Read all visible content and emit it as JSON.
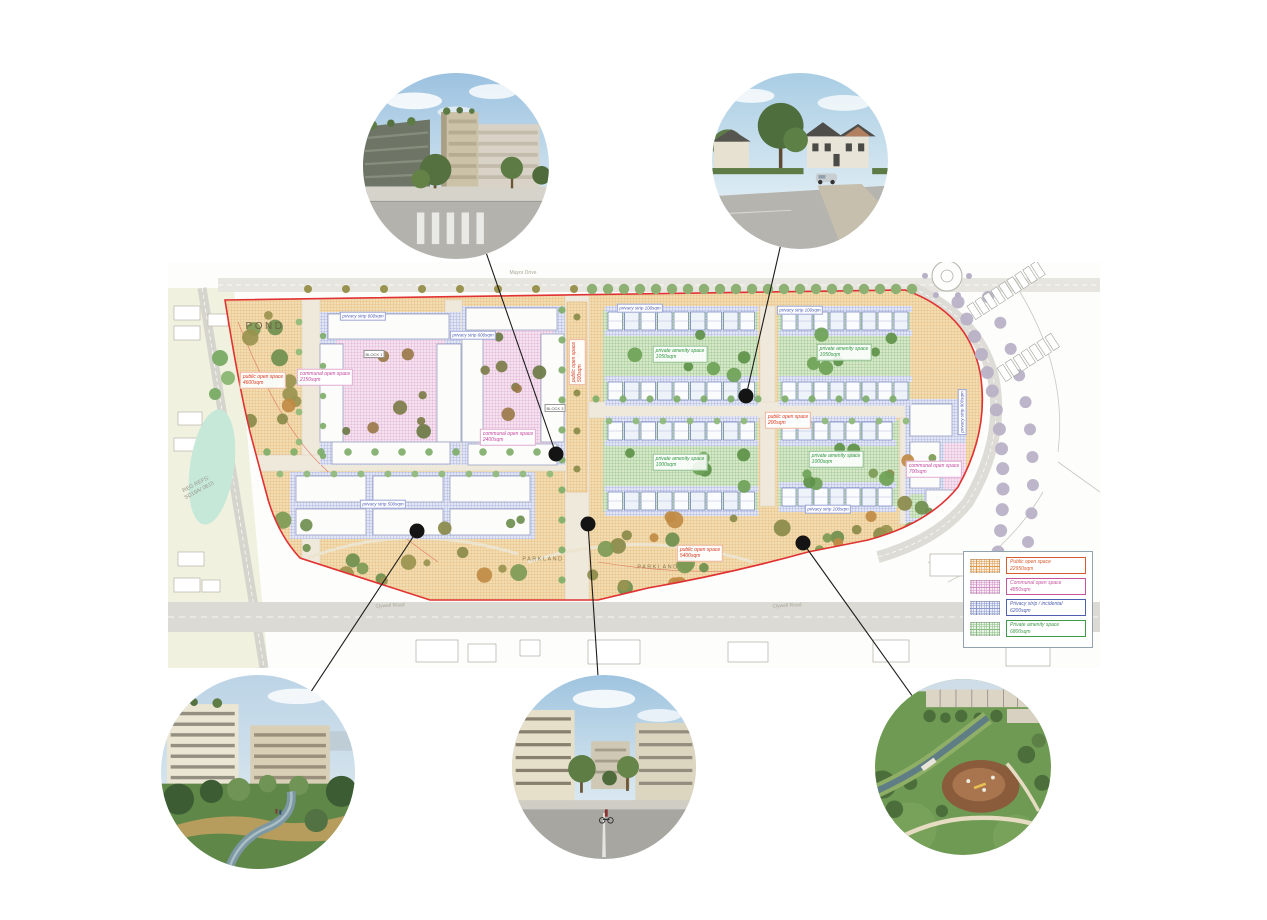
{
  "page": {
    "background": "#ffffff"
  },
  "legend": {
    "items": [
      {
        "label": "Public open space",
        "area": "22950sqm",
        "color": "#d95b2e",
        "fill": "#fbf0e2",
        "line": "#e09a4e"
      },
      {
        "label": "Communal open space",
        "area": "4850sqm",
        "color": "#c4559e",
        "fill": "#f8ecf5",
        "line": "#d492c6"
      },
      {
        "label": "Privacy strip / incidental",
        "area": "6200sqm",
        "color": "#4f5fb0",
        "fill": "#eceef8",
        "line": "#8d99cf"
      },
      {
        "label": "Private amenity space",
        "area": "6800sqm",
        "color": "#3f9a48",
        "fill": "#ebf4e8",
        "line": "#8bbd85"
      }
    ]
  },
  "plan": {
    "labels": [
      {
        "type": "area-lg",
        "text": [
          "POND"
        ],
        "x": 97,
        "y": 65
      },
      {
        "type": "area",
        "text": [
          "PARKLAND"
        ],
        "x": 375,
        "y": 298
      },
      {
        "type": "area",
        "text": [
          "PARKLAND"
        ],
        "x": 490,
        "y": 306
      },
      {
        "type": "public",
        "text": [
          "public open space",
          "4600sqm"
        ],
        "x": 95,
        "y": 118
      },
      {
        "type": "public",
        "text": [
          "public open space",
          "5400sqm"
        ],
        "x": 532,
        "y": 291
      },
      {
        "type": "public",
        "text": [
          "public open space",
          "500sqm"
        ],
        "x": 409,
        "y": 100,
        "rot": -90
      },
      {
        "type": "public",
        "text": [
          "public open space",
          "200sqm"
        ],
        "x": 620,
        "y": 158
      },
      {
        "type": "communal",
        "text": [
          "communal open space",
          "2150sqm"
        ],
        "x": 157,
        "y": 115
      },
      {
        "type": "communal",
        "text": [
          "communal open space",
          "2400sqm"
        ],
        "x": 340,
        "y": 175
      },
      {
        "type": "communal",
        "text": [
          "communal open space",
          "700sqm"
        ],
        "x": 766,
        "y": 207
      },
      {
        "type": "private",
        "text": [
          "private amenity space",
          "1050sqm"
        ],
        "x": 512,
        "y": 92
      },
      {
        "type": "private",
        "text": [
          "private amenity space",
          "1050sqm"
        ],
        "x": 676,
        "y": 90
      },
      {
        "type": "private",
        "text": [
          "private amenity space",
          "1000sqm"
        ],
        "x": 512,
        "y": 200
      },
      {
        "type": "private",
        "text": [
          "private amenity space",
          "1000sqm"
        ],
        "x": 668,
        "y": 197
      },
      {
        "type": "privacy",
        "text": [
          "privacy strip 600sqm"
        ],
        "x": 195,
        "y": 54
      },
      {
        "type": "privacy",
        "text": [
          "privacy strip 600sqm"
        ],
        "x": 305,
        "y": 73
      },
      {
        "type": "privacy",
        "text": [
          "privacy strip 100sqm"
        ],
        "x": 472,
        "y": 46
      },
      {
        "type": "privacy",
        "text": [
          "privacy strip 100sqm"
        ],
        "x": 632,
        "y": 48
      },
      {
        "type": "privacy",
        "text": [
          "privacy strip 100sqm"
        ],
        "x": 660,
        "y": 247
      },
      {
        "type": "privacy",
        "text": [
          "privacy strip 500sqm"
        ],
        "x": 215,
        "y": 242
      },
      {
        "type": "privacy",
        "text": [
          "privacy strip 900sqm"
        ],
        "x": 794,
        "y": 150,
        "rot": -90
      },
      {
        "type": "block",
        "text": [
          "BLOCK 1"
        ],
        "x": 206,
        "y": 92
      },
      {
        "type": "block",
        "text": [
          "BLOCK 3"
        ],
        "x": 387,
        "y": 146
      },
      {
        "type": "ref",
        "text": [
          "REG REFS:",
          "SD19A/ 0615"
        ],
        "x": 30,
        "y": 226,
        "rot": -28
      },
      {
        "type": "road",
        "text": [
          "Mayor Drive"
        ],
        "x": 355,
        "y": 11
      },
      {
        "type": "road",
        "text": [
          "Clywell Road"
        ],
        "x": 222,
        "y": 344,
        "rot": -3
      },
      {
        "type": "road",
        "text": [
          "Clywell Road"
        ],
        "x": 619,
        "y": 344,
        "rot": -3
      }
    ]
  },
  "callouts": [
    {
      "id": "apartments-street",
      "desc": "apartment blocks street view",
      "cx": 456,
      "cy": 166,
      "r": 93,
      "dot": [
        556,
        454
      ]
    },
    {
      "id": "housing-street",
      "desc": "suburban housing street view",
      "cx": 800,
      "cy": 161,
      "r": 88,
      "dot": [
        746,
        396
      ]
    },
    {
      "id": "riverside-park",
      "desc": "apartments overlooking stream park",
      "cx": 258,
      "cy": 772,
      "r": 97,
      "dot": [
        417,
        531
      ]
    },
    {
      "id": "apartment-avenue",
      "desc": "tree lined avenue between apartments",
      "cx": 604,
      "cy": 767,
      "r": 92,
      "dot": [
        588,
        524
      ]
    },
    {
      "id": "parkland-playground",
      "desc": "aerial view of playground in parkland",
      "cx": 963,
      "cy": 767,
      "r": 88,
      "dot": [
        803,
        543
      ]
    }
  ]
}
